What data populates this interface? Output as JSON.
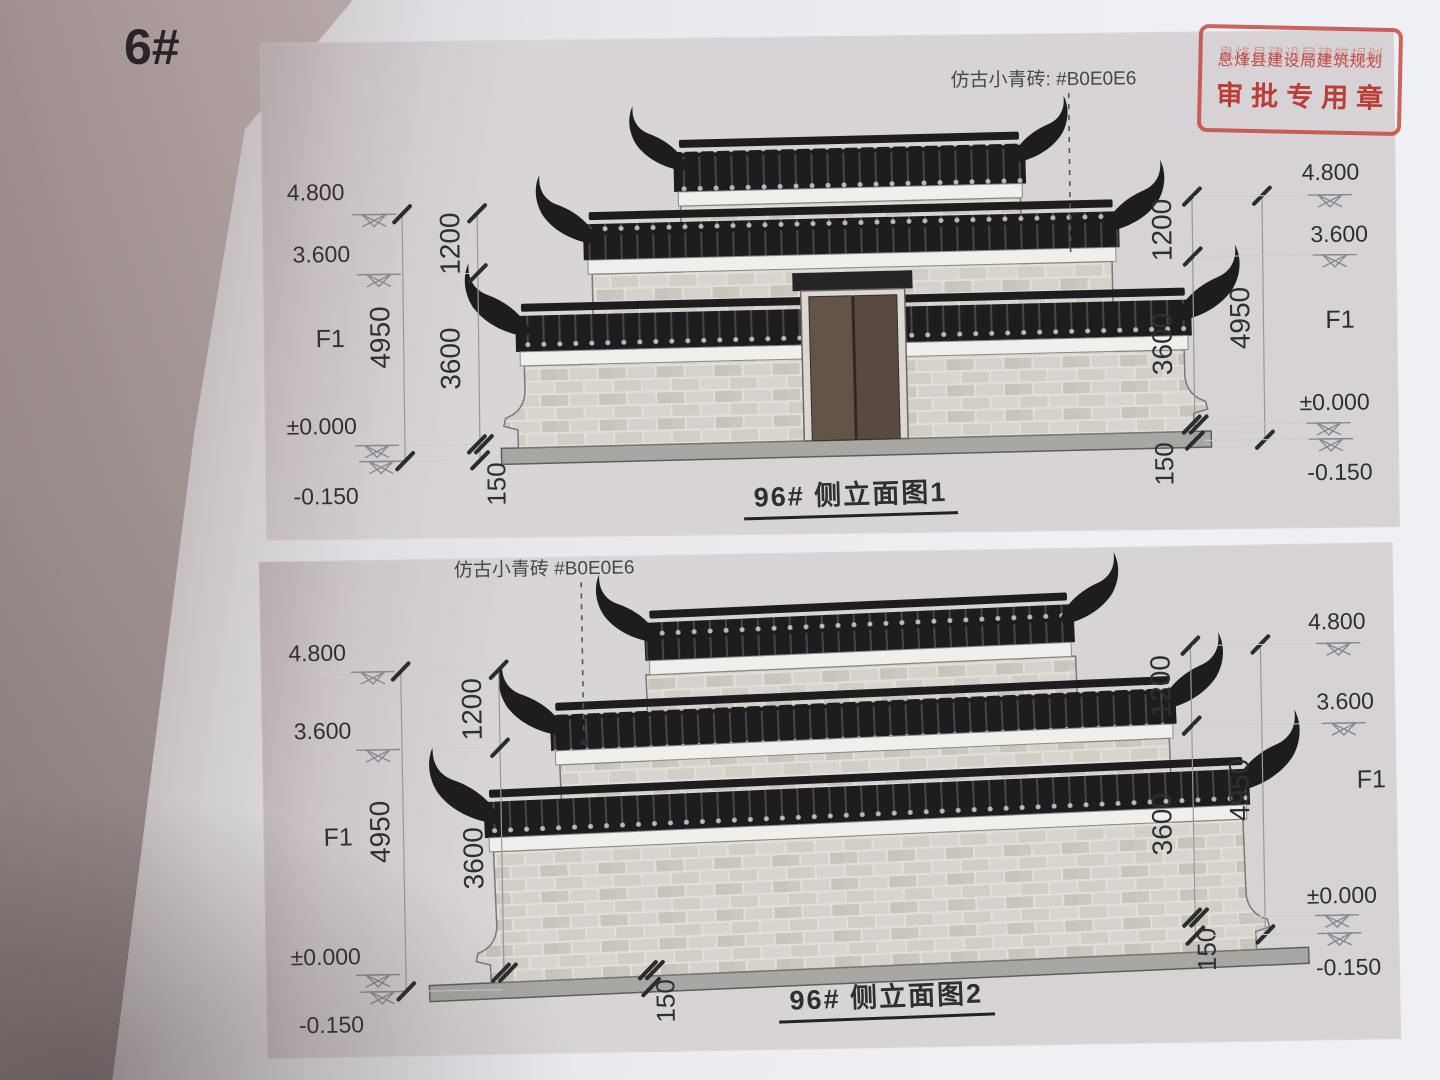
{
  "page_number": "6#",
  "stamp": {
    "line1": "息烽县建设局建筑规划",
    "line2": "审批专用章"
  },
  "d1": {
    "title": "96# 侧立面图1",
    "material": "仿古小青砖: #B0E0E6",
    "lv": {
      "a": "4.800",
      "b": "3.600",
      "c": "F1",
      "d": "±0.000",
      "e": "-0.150"
    },
    "dim": {
      "total": "4950",
      "top": "1200",
      "wall": "3600",
      "plinth": "150"
    }
  },
  "d2": {
    "title": "96# 侧立面图2",
    "material": "仿古小青砖  #B0E0E6",
    "lv": {
      "a": "4.800",
      "b": "3.600",
      "c": "F1",
      "d": "±0.000",
      "e": "-0.150"
    },
    "dim": {
      "total": "4950",
      "top": "1200",
      "wall": "3600",
      "plinth": "150"
    }
  },
  "colors": {
    "brick_note_value": "#B0E0E6",
    "roof_black": "#1d1d1f",
    "brick_light": "#d6d2cb",
    "door_brown": "#5d4f44",
    "plinth_gray": "#a8a7a3",
    "stamp_red": "#c03c32"
  }
}
